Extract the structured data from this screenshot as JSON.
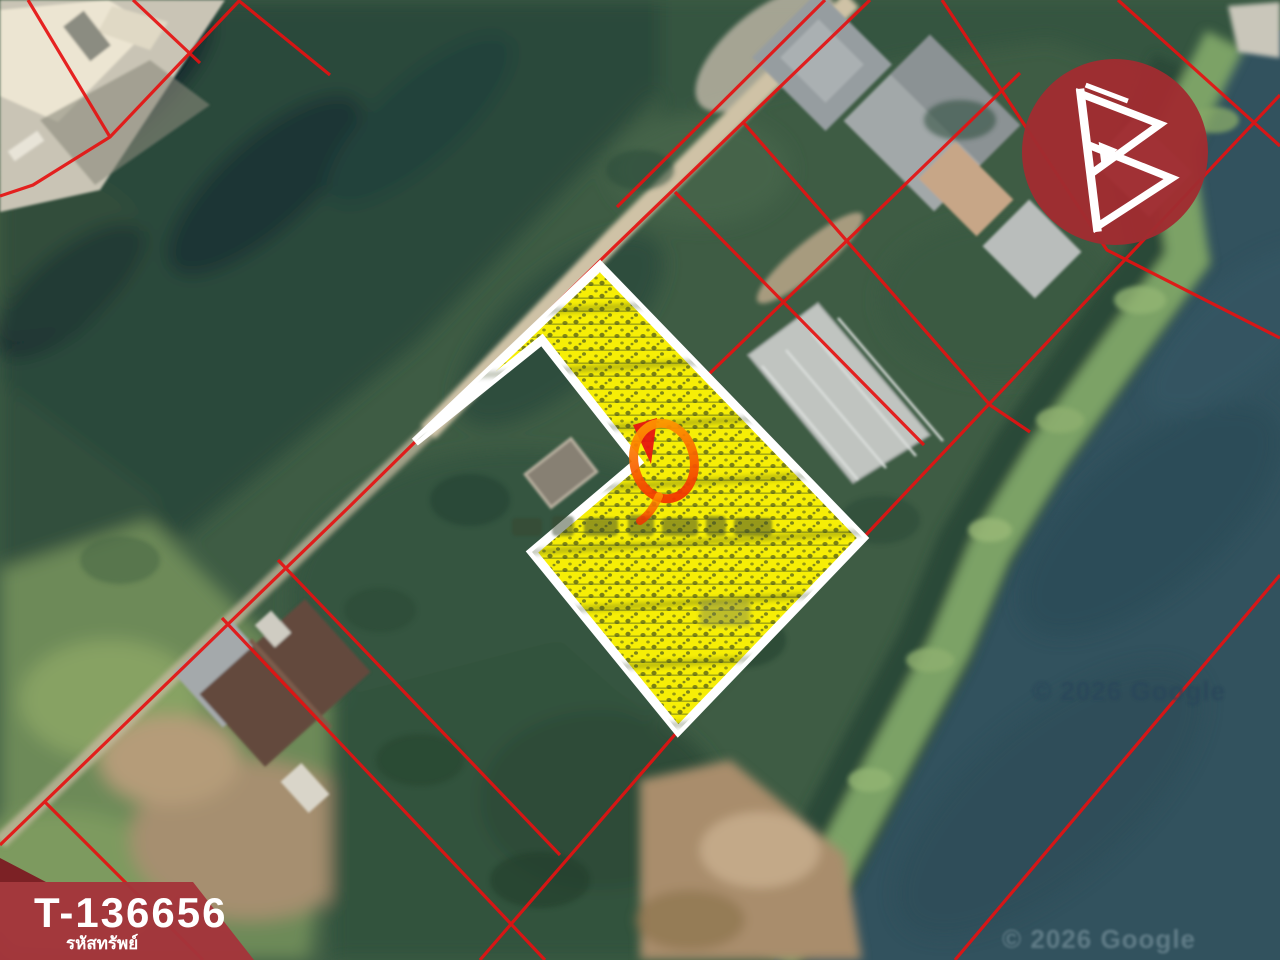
{
  "listing_badge": {
    "property_code": "T-136656",
    "property_code_label": "รหัสทรัพย์"
  },
  "map": {
    "watermark_center": "© 2026 Google",
    "watermark_bottom": "© 2026 Google",
    "highlighted_parcel": {
      "marker": "orange-ring-marker",
      "outline": "white",
      "fill_style": "yellow-hatched"
    }
  },
  "branding": {
    "logo_icon": "b-triangles-icon"
  },
  "colors": {
    "brand_red": "#a02c31",
    "banner_red": "#a4353b",
    "banner_red_dark": "#7c2125",
    "cadastral_red": "#e51212",
    "parcel_yellow": "#f6ee06",
    "parcel_outline": "#ffffff",
    "marker_orange": "#ff7300",
    "water": "#32525e",
    "watermark_center_color": "#29475a",
    "watermark_bottom_color": "#7f98a2"
  }
}
